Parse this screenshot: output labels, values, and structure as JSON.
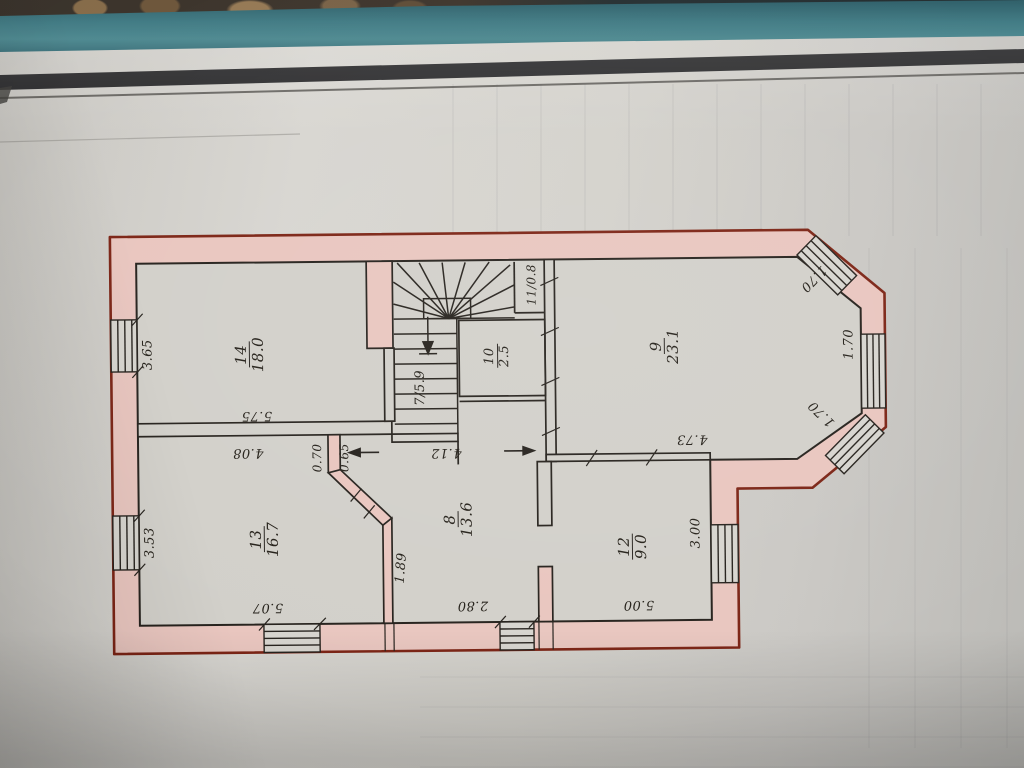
{
  "document": {
    "kind": "hand-drawn floor plan photo",
    "floor_rooms_visible": [
      "7",
      "8",
      "9",
      "10",
      "11",
      "12",
      "13",
      "14"
    ]
  },
  "rooms": {
    "r7": {
      "label": "7/5.9",
      "number": "7",
      "area": "5.9",
      "type": "staircase"
    },
    "r8": {
      "number": "8",
      "area": "13.6"
    },
    "r9": {
      "number": "9",
      "area": "23.1"
    },
    "r10": {
      "number": "10",
      "area": "2.5"
    },
    "r11": {
      "label": "11/0.8",
      "number": "11",
      "area": "0.8"
    },
    "r12": {
      "number": "12",
      "area": "9.0"
    },
    "r13": {
      "number": "13",
      "area": "16.7"
    },
    "r14": {
      "number": "14",
      "area": "18.0"
    }
  },
  "dims": {
    "left_room14": "3.65",
    "left_room13": "3.53",
    "width_room14": "5.75",
    "width_room13": "4.08",
    "stub_left": "0.70",
    "stub_right": "0.65",
    "hall_length": "4.12",
    "diag_wall": "1.89",
    "bottom_room13": "5.07",
    "bottom_hall": "2.80",
    "bottom_room12": "5.00",
    "side_room12": "3.00",
    "width_room9": "4.73",
    "bay_top": "1.70",
    "bay_side": "1.70",
    "bay_bottom": "1.70"
  },
  "icons": {
    "stair_direction_arrow": "down-arrow-with-base",
    "hall_dim_arrow_left": "left-arrow",
    "hall_dim_arrow_right": "right-arrow"
  },
  "colors": {
    "wall_fill": "#e9c6bf",
    "wall_outline": "#7c2415",
    "ink_line": "#26221d",
    "paper": "#d2d0ca",
    "teal_strip": "#2e6e78",
    "rule_band": "#1b1b1d"
  }
}
